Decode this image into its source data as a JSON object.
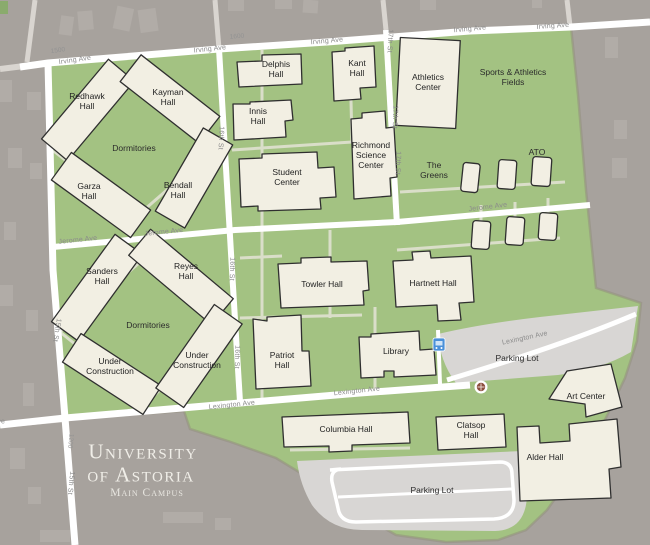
{
  "map": {
    "title": {
      "line1": "University",
      "line2": "of Astoria",
      "line3": "Main Campus"
    },
    "streets": {
      "irving": "Irving Ave",
      "jerome": "Jerome Ave",
      "lexington": "Lexington Ave",
      "fifteenth": "15th St",
      "sixteenth": "16th St",
      "seventeenth": "17th St"
    },
    "blocks": {
      "b1200": "1200",
      "b1500": "1500",
      "b1600": "1600"
    },
    "buildings": {
      "redhawk": "Redhawk\nHall",
      "kayman": "Kayman\nHall",
      "garza": "Garza\nHall",
      "bendall": "Bendall\nHall",
      "delphis": "Delphis\nHall",
      "innis": "Innis\nHall",
      "kant": "Kant\nHall",
      "student": "Student\nCenter",
      "richmond": "Richmond\nScience\nCenter",
      "athletics": "Athletics\nCenter",
      "sanders": "Sanders\nHall",
      "reyes": "Reyes\nHall",
      "under_construction": "Under\nConstruction",
      "towler": "Towler Hall",
      "hartnett": "Hartnett Hall",
      "patriot": "Patriot\nHall",
      "library": "Library",
      "columbia": "Columbia Hall",
      "clatsop": "Clatsop\nHall",
      "art": "Art Center",
      "alder": "Alder Hall"
    },
    "areas": {
      "dormitories": "Dormitories",
      "fields": "Sports & Athletics\nFields",
      "greens": "The\nGreens",
      "ato": "ATO",
      "parking": "Parking Lot"
    },
    "icons": {
      "bus_stop": "bus-stop-icon",
      "poi": "roundabout-marker-icon"
    },
    "colors": {
      "campus_green": "#a3c282",
      "outside_gray": "#a7a29d",
      "street_white": "#ffffff",
      "building_fill": "#f2efe3",
      "building_stroke": "#2f2f2f",
      "parking_gray": "#d8d6d4",
      "bus_blue": "#4a90d9",
      "marker_red": "#8d4f3f",
      "title_text": "#f0eee8"
    }
  }
}
